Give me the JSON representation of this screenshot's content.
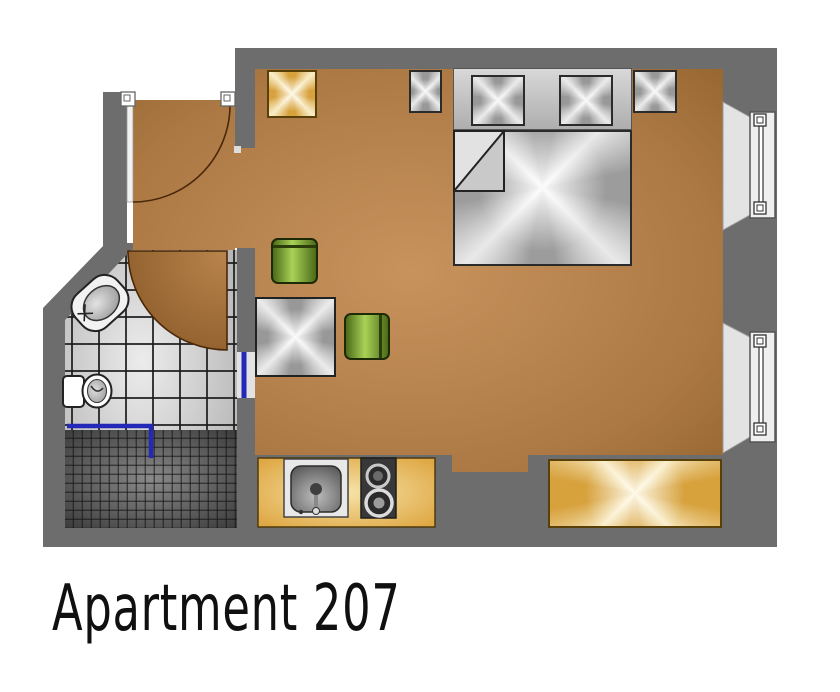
{
  "title": "Apartment 207",
  "colors": {
    "wall": "#6d6d6d",
    "floor_light": "#c8935d",
    "floor_dark": "#96662f",
    "wedge_brown": "#8e5e2b",
    "curtain_blue": "#2328b8",
    "tile_light": "#ececec",
    "grout_dark": "#1b1b1b",
    "shower_dark": "#3c3c3c",
    "counter_gold": "#dfa845",
    "sheen_gold_light": "#f9edc8",
    "stool_green": "#a8d257",
    "furniture_gray": "#9c9c9c",
    "window_frame": "#efefef",
    "title_color": "#101010"
  },
  "plan": {
    "rooms": [
      "main-room",
      "bathroom",
      "entry-hall"
    ],
    "fixtures": [
      "entry-door",
      "bathroom-door",
      "window-upper",
      "window-lower",
      "bed",
      "headboard",
      "pillow-left",
      "pillow-right",
      "nightstand-left",
      "nightstand-right",
      "seat-cushion-yellow",
      "side-table",
      "green-stool-round",
      "green-stool-square",
      "kitchen-counter",
      "kitchen-sink",
      "cooktop",
      "wash-basin",
      "toilet",
      "shower",
      "shower-curtain",
      "bench-bay"
    ]
  }
}
